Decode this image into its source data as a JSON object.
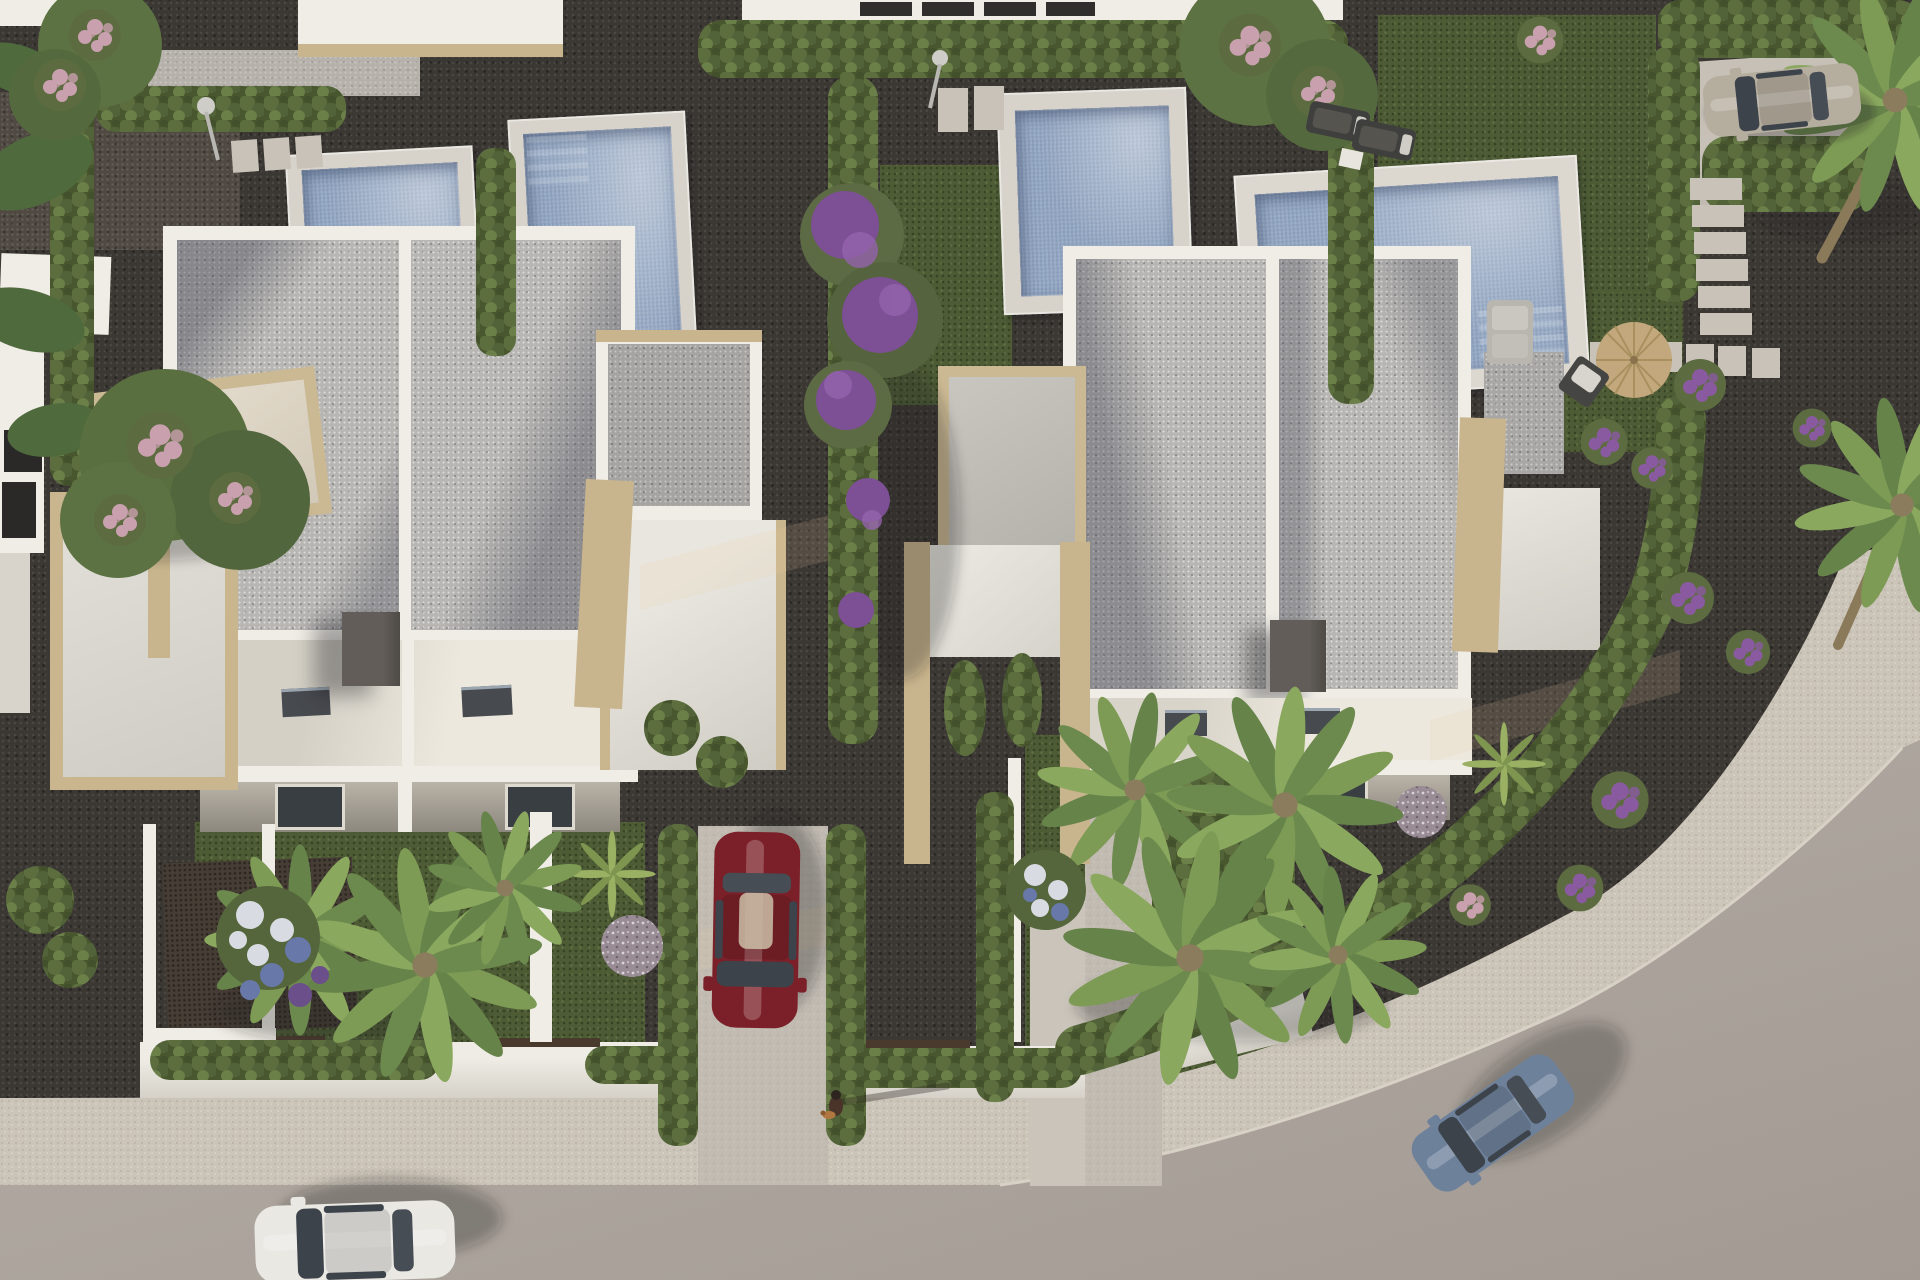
{
  "meta": {
    "title": "Aerial 3D render of a modern villa development at golden hour",
    "type": "photorealistic architectural rendering",
    "view": "top-down aerial"
  },
  "scene": {
    "palette": {
      "road": "#b0a8a0",
      "sidewalk": "#cbc4b9",
      "driveway_concrete": "#c1bbb2",
      "house_white": "#f0ede6",
      "roof_gravel": "#b8b6b3",
      "stone_tan": "#c9b58d",
      "pool_water": "#96a9c4",
      "pool_deck": "#d7d3ca",
      "hedge_green": "#57663c",
      "grass_green": "#4e5c36",
      "gravel_dark": "#3b3733",
      "chimney_gray": "#5e5954",
      "car_red": "#7b2028",
      "car_white": "#eae8e3",
      "car_blue": "#6e819b",
      "car_silver": "#b5ae9f",
      "flower_purple": "#8a5aa0",
      "flower_pink": "#c9a0ae",
      "flower_blue": "#6878a8",
      "umbrella_straw": "#c2a87c"
    },
    "inventory": {
      "villas": 2,
      "pools": 4,
      "cars": 4,
      "pedestrians": 1,
      "dogs": 1,
      "cars_list": [
        {
          "color_name": "white",
          "location": "road, bottom left"
        },
        {
          "color_name": "dark red",
          "location": "driveway, center"
        },
        {
          "color_name": "blue gray",
          "location": "road, bottom right"
        },
        {
          "color_name": "silver beige",
          "location": "driveway, top right"
        }
      ],
      "landscape": [
        "cypress hedges",
        "palm trees",
        "bougainvillea",
        "lilac flower shrubs",
        "lawn patches",
        "dark gravel beds",
        "stepping stone paths",
        "pebble ball plants"
      ],
      "amenities": [
        "private pools",
        "sun loungers",
        "straw parasol",
        "deck chairs",
        "outdoor showers",
        "roof terraces",
        "stone-clad pergolas"
      ]
    },
    "labels": {
      "road": "curved asphalt road",
      "sidewalk": "speckled concrete sidewalk",
      "villa_left": "left semi-detached villa with gravel flat roof",
      "villa_right": "right semi-detached villa with gravel flat roof",
      "pool": "private swimming pool",
      "person": "pedestrian walking a dog"
    }
  }
}
